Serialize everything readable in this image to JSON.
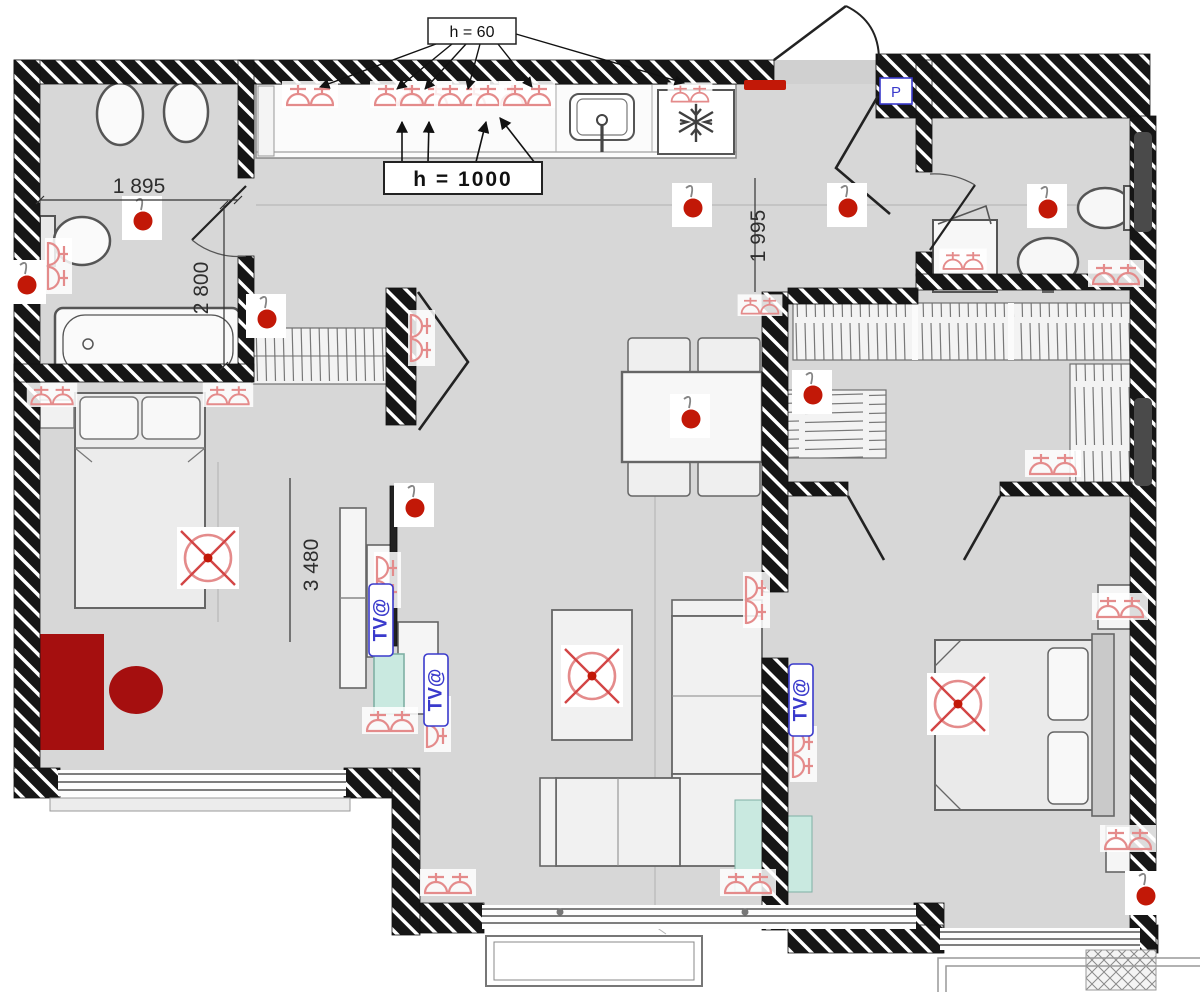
{
  "title": "apartment electrical floor plan",
  "colors": {
    "wall": "#161616",
    "floor": "#d7d7d7",
    "red": "#c21807",
    "red_mid": "#d34545",
    "red_soft": "#e48b8b",
    "red_dark": "#a50f0f",
    "blue": "#3a3acc",
    "mint": "#c9e9e0",
    "pink": "#efb6b6"
  },
  "labels": {
    "mount_height_low": "h = 60",
    "mount_height_counter": "h = 1000",
    "tv_outlet": "TV@",
    "intercom": "Р"
  },
  "dimensions": {
    "bathroom_width": "1 895",
    "bathroom_depth": "2 800",
    "bedroom1_depth": "3 480",
    "hall_width": "1 995"
  }
}
